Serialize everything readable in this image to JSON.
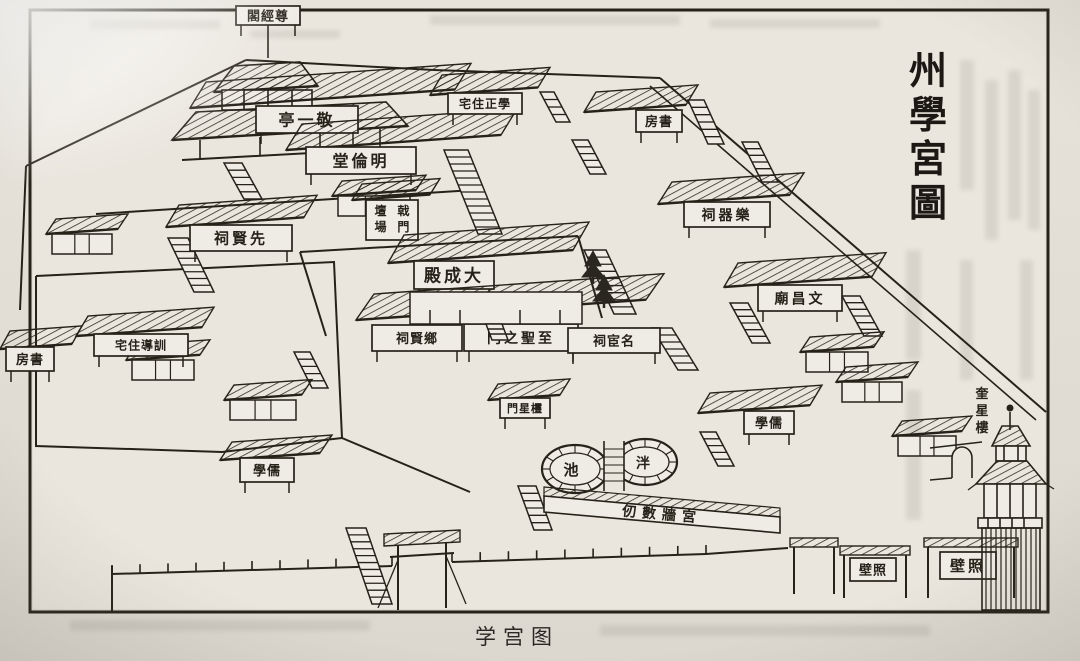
{
  "page": {
    "caption": "学宫图",
    "title": {
      "name": "州學宮圖",
      "chars": [
        "州",
        "學",
        "宮",
        "圖"
      ]
    },
    "colors": {
      "paper": "#dedad2",
      "inner_paper": "#eae6de",
      "ink": "#262219",
      "ghost": "#8d8780"
    }
  },
  "map": {
    "reading_direction": "right-to-left",
    "buildings": [
      {
        "id": "zunjingge-plaque",
        "kind": "plaque",
        "name": "尊經閣",
        "display": "閣經尊",
        "x": 236,
        "y": 6,
        "w": 64,
        "h": 19,
        "font": 13
      },
      {
        "id": "jingyiting",
        "kind": "hall",
        "name": "敬一亭",
        "display": "亭一敬",
        "x": 256,
        "y": 106,
        "w": 102,
        "h": 27,
        "font": 16,
        "roof": [
          190,
          108,
          265,
          26,
          16
        ]
      },
      {
        "id": "mingluntang",
        "kind": "hall",
        "name": "明倫堂",
        "display": "堂倫明",
        "x": 306,
        "y": 147,
        "w": 110,
        "h": 27,
        "font": 16,
        "roof": [
          286,
          150,
          215,
          26,
          16
        ]
      },
      {
        "id": "xuezheng-zhuzhai",
        "kind": "hall",
        "name": "學正住宅",
        "display": "宅住正學",
        "x": 448,
        "y": 93,
        "w": 74,
        "h": 21,
        "font": 12,
        "roof": [
          430,
          95,
          108,
          20,
          12
        ]
      },
      {
        "id": "shufang-right",
        "kind": "hall",
        "name": "書房",
        "display": "房書",
        "x": 636,
        "y": 110,
        "w": 46,
        "h": 22,
        "font": 13,
        "roof": [
          584,
          112,
          102,
          20,
          12
        ]
      },
      {
        "id": "xianxian-ci",
        "kind": "hall",
        "name": "先賢祠",
        "display": "祠賢先",
        "x": 190,
        "y": 225,
        "w": 102,
        "h": 26,
        "font": 15,
        "roof": [
          166,
          227,
          138,
          22,
          13
        ]
      },
      {
        "id": "jimen-tanchang",
        "kind": "colbox",
        "name": "戟門壇場",
        "col_right": "戟門",
        "col_left": "壇場",
        "x": 366,
        "y": 200,
        "w": 52,
        "h": 40,
        "font": 12,
        "roof": [
          352,
          200,
          78,
          16,
          10
        ]
      },
      {
        "id": "dachengdian",
        "kind": "hall",
        "name": "大成殿",
        "display": "殿成大",
        "x": 414,
        "y": 261,
        "w": 80,
        "h": 28,
        "font": 17,
        "roof": [
          388,
          263,
          185,
          28,
          16
        ]
      },
      {
        "id": "yueqi-ci",
        "kind": "hall",
        "name": "樂器祠",
        "display": "祠器樂",
        "x": 684,
        "y": 202,
        "w": 86,
        "h": 25,
        "font": 14,
        "roof": [
          658,
          204,
          132,
          22,
          14
        ]
      },
      {
        "id": "xiangxian-ci",
        "kind": "plaque",
        "name": "鄉賢祠",
        "display": "祠賢鄉",
        "x": 372,
        "y": 325,
        "w": 90,
        "h": 26,
        "font": 13
      },
      {
        "id": "zhisheng-men",
        "kind": "hall",
        "name": "至聖之門",
        "display": "門之聖至",
        "x": 464,
        "y": 324,
        "w": 114,
        "h": 27,
        "font": 14,
        "roof": [
          356,
          320,
          290,
          26,
          18
        ]
      },
      {
        "id": "minghuan-ci",
        "kind": "plaque",
        "name": "名宦祠",
        "display": "祠宦名",
        "x": 568,
        "y": 328,
        "w": 92,
        "h": 25,
        "font": 13
      },
      {
        "id": "wenchang-miao",
        "kind": "hall",
        "name": "文昌廟",
        "display": "廟昌文",
        "x": 758,
        "y": 285,
        "w": 84,
        "h": 26,
        "font": 14,
        "roof": [
          724,
          287,
          148,
          24,
          14
        ]
      },
      {
        "id": "xundao-zhuzhai",
        "kind": "hall",
        "name": "訓導住宅",
        "display": "宅住導訓",
        "x": 94,
        "y": 334,
        "w": 94,
        "h": 22,
        "font": 12,
        "roof": [
          76,
          336,
          126,
          20,
          12
        ]
      },
      {
        "id": "shufang-left",
        "kind": "hall",
        "name": "書房",
        "display": "房書",
        "x": 6,
        "y": 347,
        "w": 48,
        "h": 24,
        "font": 13,
        "roof": [
          0,
          349,
          72,
          18,
          10
        ]
      },
      {
        "id": "ruxue-left",
        "kind": "hall",
        "name": "儒學",
        "display": "學儒",
        "x": 240,
        "y": 458,
        "w": 54,
        "h": 24,
        "font": 13,
        "roof": [
          220,
          460,
          100,
          18,
          12
        ]
      },
      {
        "id": "lingxing-men",
        "kind": "hall",
        "name": "欞星門",
        "display": "門星欞",
        "x": 500,
        "y": 398,
        "w": 50,
        "h": 20,
        "font": 11,
        "roof": [
          488,
          400,
          72,
          16,
          10
        ]
      },
      {
        "id": "ruxue-right",
        "kind": "hall",
        "name": "儒學",
        "display": "學儒",
        "x": 744,
        "y": 411,
        "w": 50,
        "h": 23,
        "font": 13,
        "roof": [
          698,
          413,
          112,
          20,
          12
        ]
      },
      {
        "id": "zhaobi-1",
        "kind": "archway",
        "name": "照壁",
        "display": "壁照",
        "x": 840,
        "y": 546,
        "w": 70,
        "h": 52,
        "px": 850,
        "py": 558,
        "pw": 46,
        "ph": 23,
        "font": 13
      },
      {
        "id": "zhaobi-2",
        "kind": "archway",
        "name": "照壁",
        "display": "壁照",
        "x": 924,
        "y": 538,
        "w": 94,
        "h": 60,
        "px": 940,
        "py": 552,
        "pw": 56,
        "ph": 27,
        "font": 15
      },
      {
        "id": "paifang-plain",
        "kind": "archway",
        "name": "牌坊",
        "x": 790,
        "y": 538,
        "w": 48,
        "h": 56
      }
    ],
    "houses": [
      {
        "x": 52,
        "y": 226,
        "w": 60
      },
      {
        "x": 338,
        "y": 188,
        "w": 72
      },
      {
        "x": 132,
        "y": 352,
        "w": 62
      },
      {
        "x": 230,
        "y": 392,
        "w": 66
      },
      {
        "x": 806,
        "y": 344,
        "w": 62
      },
      {
        "x": 842,
        "y": 374,
        "w": 60
      },
      {
        "x": 898,
        "y": 428,
        "w": 58
      }
    ],
    "stairs": [
      {
        "x": 168,
        "y": 238,
        "w": 20,
        "dx": 26,
        "drop": 54
      },
      {
        "x": 224,
        "y": 163,
        "w": 18,
        "dx": 20,
        "drop": 36
      },
      {
        "x": 444,
        "y": 150,
        "w": 24,
        "dx": 34,
        "drop": 84
      },
      {
        "x": 540,
        "y": 92,
        "w": 14,
        "dx": 16,
        "drop": 30
      },
      {
        "x": 572,
        "y": 140,
        "w": 16,
        "dx": 18,
        "drop": 34
      },
      {
        "x": 688,
        "y": 100,
        "w": 16,
        "dx": 20,
        "drop": 44
      },
      {
        "x": 742,
        "y": 142,
        "w": 16,
        "dx": 20,
        "drop": 40
      },
      {
        "x": 584,
        "y": 250,
        "w": 22,
        "dx": 30,
        "drop": 64
      },
      {
        "x": 652,
        "y": 328,
        "w": 20,
        "dx": 26,
        "drop": 42
      },
      {
        "x": 730,
        "y": 303,
        "w": 18,
        "dx": 22,
        "drop": 40
      },
      {
        "x": 842,
        "y": 296,
        "w": 18,
        "dx": 22,
        "drop": 40
      },
      {
        "x": 518,
        "y": 486,
        "w": 18,
        "dx": 16,
        "drop": 44
      },
      {
        "x": 700,
        "y": 432,
        "w": 16,
        "dx": 18,
        "drop": 34
      },
      {
        "x": 346,
        "y": 528,
        "w": 20,
        "dx": 26,
        "drop": 76
      },
      {
        "x": 294,
        "y": 352,
        "w": 16,
        "dx": 18,
        "drop": 36
      }
    ],
    "walls": [
      {
        "pts": [
          [
            26,
            166
          ],
          [
            246,
            60
          ]
        ]
      },
      {
        "pts": [
          [
            246,
            60
          ],
          [
            434,
            70
          ]
        ]
      },
      {
        "pts": [
          [
            434,
            70
          ],
          [
            660,
            78
          ]
        ]
      },
      {
        "pts": [
          [
            26,
            166
          ],
          [
            20,
            310
          ]
        ]
      },
      {
        "pts": [
          [
            96,
            214
          ],
          [
            474,
            190
          ]
        ]
      },
      {
        "pts": [
          [
            300,
            252
          ],
          [
            578,
            236
          ]
        ]
      },
      {
        "pts": [
          [
            300,
            252
          ],
          [
            326,
            336
          ]
        ]
      },
      {
        "pts": [
          [
            578,
            236
          ],
          [
            602,
            318
          ]
        ]
      },
      {
        "pts": [
          [
            660,
            78
          ],
          [
            1046,
            412
          ]
        ],
        "double": true
      },
      {
        "pts": [
          [
            36,
            276
          ],
          [
            334,
            262
          ],
          [
            342,
            438
          ],
          [
            222,
            452
          ],
          [
            36,
            446
          ],
          [
            36,
            276
          ]
        ]
      },
      {
        "pts": [
          [
            112,
            574
          ],
          [
            392,
            566
          ]
        ],
        "ticks": true
      },
      {
        "pts": [
          [
            452,
            562
          ],
          [
            706,
            554
          ]
        ],
        "ticks": true
      },
      {
        "pts": [
          [
            706,
            554
          ],
          [
            788,
            548
          ]
        ]
      },
      {
        "pts": [
          [
            112,
            566
          ],
          [
            112,
            612
          ]
        ]
      },
      {
        "pts": [
          [
            112,
            612
          ],
          [
            132,
            612
          ]
        ]
      },
      {
        "pts": [
          [
            342,
            438
          ],
          [
            470,
            492
          ]
        ]
      }
    ],
    "pond": {
      "name": "泮池",
      "char_left": "池",
      "char_right": "泮"
    },
    "wall_inscription": {
      "name": "宮牆數仞",
      "display": "仞數牆宮"
    },
    "tower": {
      "name": "奎星樓",
      "chars": [
        "奎",
        "星",
        "樓"
      ],
      "x": 962,
      "y": 398,
      "font": 13,
      "step": 17
    }
  }
}
